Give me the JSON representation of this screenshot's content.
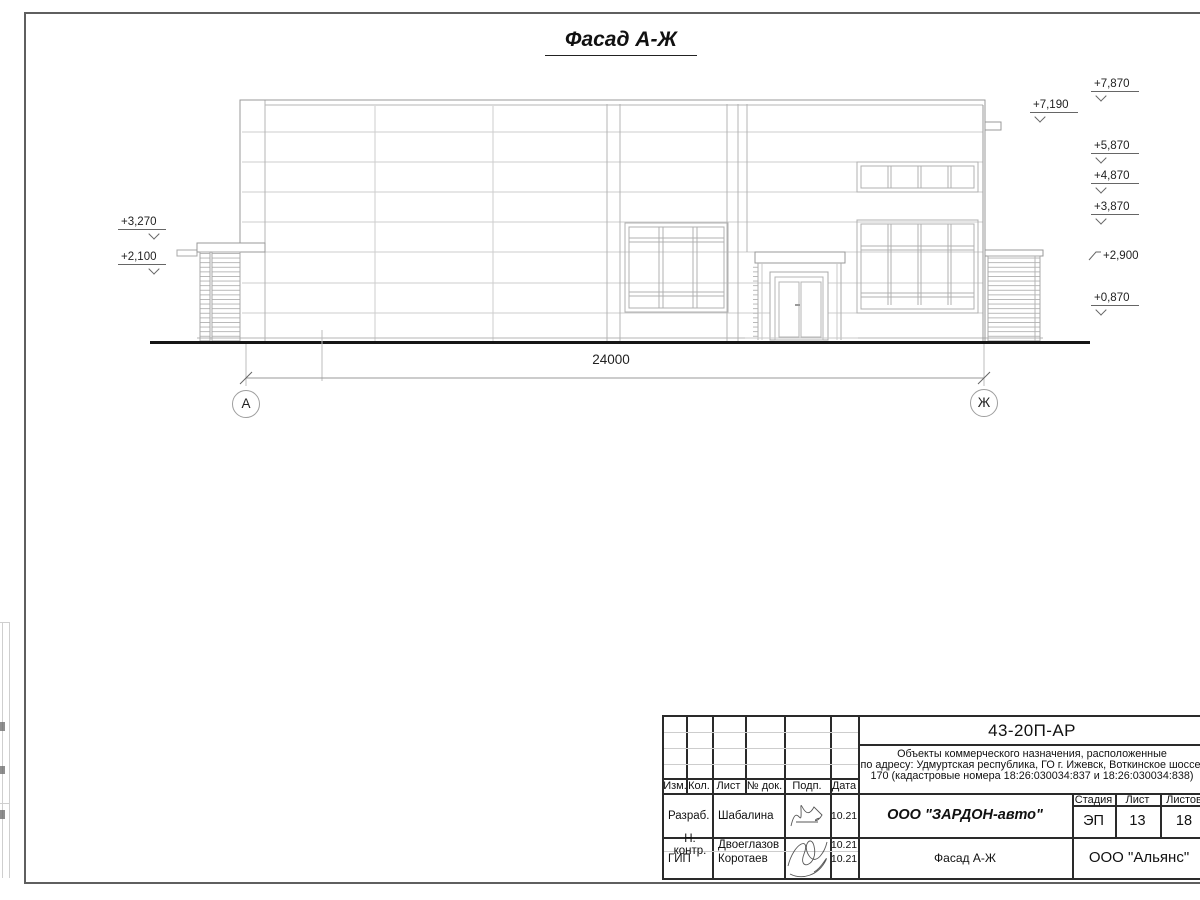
{
  "title": "Фасад А-Ж",
  "drawing": {
    "dimension_label": "24000",
    "axis_left": "А",
    "axis_right": "Ж",
    "elevations_left": [
      {
        "label": "+3,270"
      },
      {
        "label": "+2,100"
      }
    ],
    "elevations_right": [
      {
        "label": "+7,870"
      },
      {
        "label": "+7,190"
      },
      {
        "label": "+5,870"
      },
      {
        "label": "+4,870"
      },
      {
        "label": "+3,870"
      },
      {
        "label": "+2,900"
      },
      {
        "label": "+0,870"
      }
    ]
  },
  "title_block": {
    "code": "43-20П-АР",
    "description_lines": [
      "Объекты коммерческого назначения, расположенные",
      "по адресу: Удмуртская республика, ГО г. Ижевск, Воткинское шоссе,",
      "170 (кадастровые номера 18:26:030034:837 и 18:26:030034:838)"
    ],
    "columns": [
      "Изм.",
      "Кол.",
      "Лист",
      "№ док.",
      "Подп.",
      "Дата"
    ],
    "rows": [
      {
        "role": "Разраб.",
        "name": "Шабалина",
        "date": "10.21"
      },
      {
        "role": "Н. контр.",
        "name": "Двоеглазов",
        "date": "10.21"
      },
      {
        "role": "ГИП",
        "name": "Коротаев",
        "date": "10.21"
      }
    ],
    "org": "ООО \"ЗАРДОН-авто\"",
    "stage_headers": [
      "Стадия",
      "Лист",
      "Листов"
    ],
    "stage": "ЭП",
    "sheet": "13",
    "sheets": "18",
    "doc_title": "Фасад А-Ж",
    "company": "ООО \"Альянс\""
  },
  "colors": {
    "facade_line_light": "#c9c9c9",
    "facade_line_mid": "#b4b4b4",
    "outline": "#999999",
    "ground": "#161616",
    "block_line": "#2a2a2a"
  }
}
